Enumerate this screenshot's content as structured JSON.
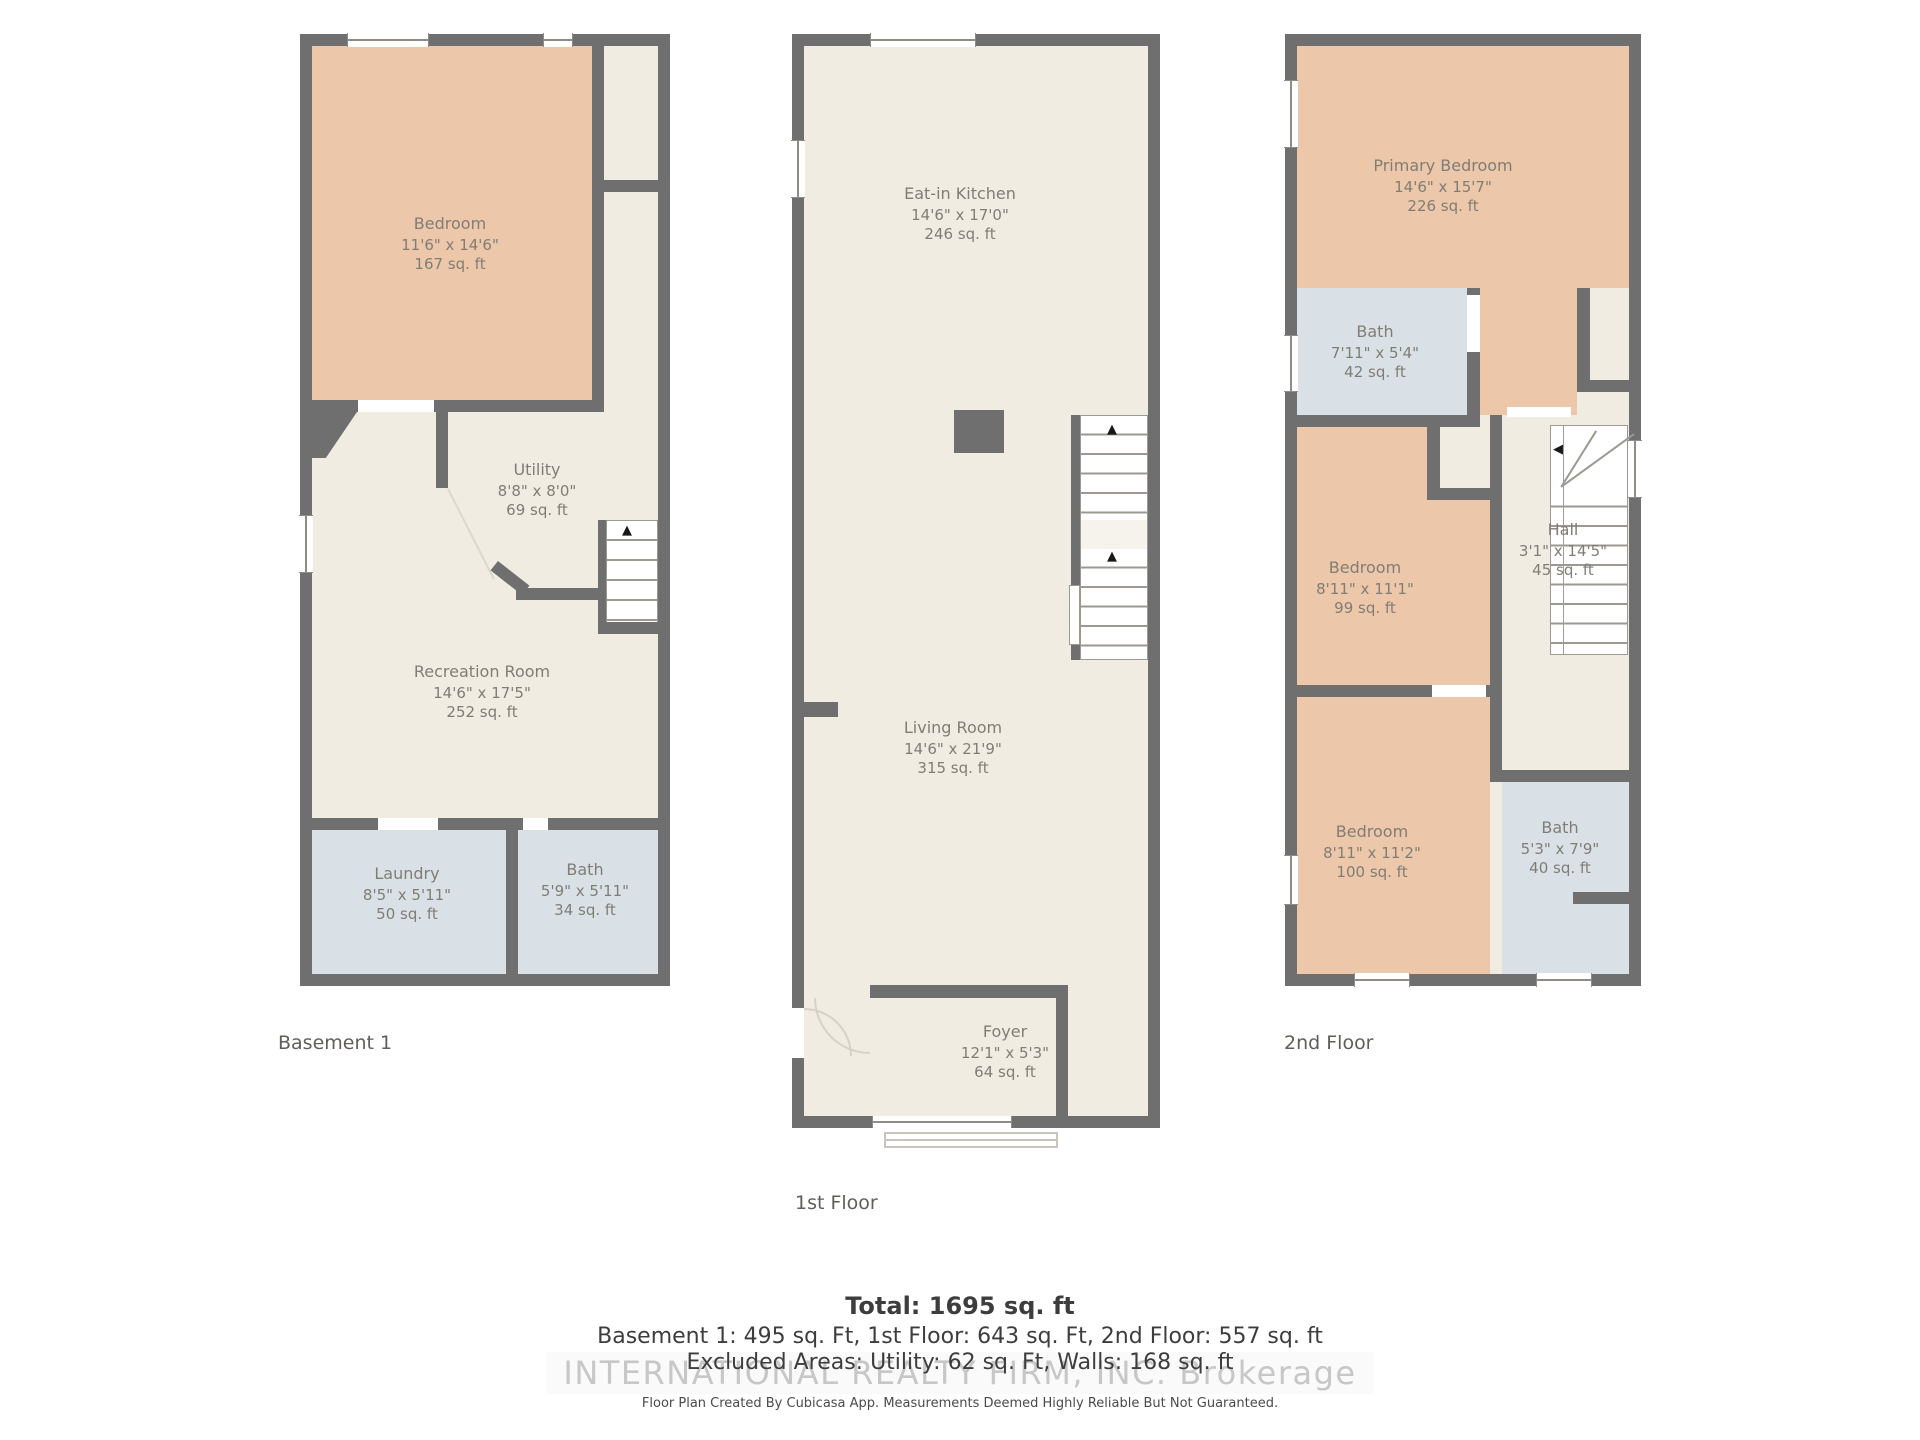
{
  "colors": {
    "wall": "#6f6f6f",
    "floor": "#f0ece2",
    "room_peach": "#ecc7a9",
    "room_blue": "#d9e1e6",
    "room_label": "#807d75",
    "summary_text": "#3d3d3d",
    "watermark": "#c7c7c7"
  },
  "icons": {
    "up_arrow": "▲",
    "left_arrow": "◀"
  },
  "floors": [
    {
      "caption": "Basement 1",
      "rooms": [
        {
          "name": "Bedroom",
          "dims": "11'6\" x 14'6\"",
          "area": "167 sq. ft"
        },
        {
          "name": "Utility",
          "dims": "8'8\" x 8'0\"",
          "area": "69 sq. ft"
        },
        {
          "name": "Recreation Room",
          "dims": "14'6\" x 17'5\"",
          "area": "252 sq. ft"
        },
        {
          "name": "Laundry",
          "dims": "8'5\" x 5'11\"",
          "area": "50 sq. ft"
        },
        {
          "name": "Bath",
          "dims": "5'9\" x 5'11\"",
          "area": "34 sq. ft"
        }
      ]
    },
    {
      "caption": "1st Floor",
      "rooms": [
        {
          "name": "Eat-in Kitchen",
          "dims": "14'6\" x 17'0\"",
          "area": "246 sq. ft"
        },
        {
          "name": "Living Room",
          "dims": "14'6\" x 21'9\"",
          "area": "315 sq. ft"
        },
        {
          "name": "Foyer",
          "dims": "12'1\" x 5'3\"",
          "area": "64 sq. ft"
        }
      ]
    },
    {
      "caption": "2nd Floor",
      "rooms": [
        {
          "name": "Primary Bedroom",
          "dims": "14'6\" x 15'7\"",
          "area": "226 sq. ft"
        },
        {
          "name": "Bath",
          "dims": "7'11\" x 5'4\"",
          "area": "42 sq. ft"
        },
        {
          "name": "Bedroom",
          "dims": "8'11\" x 11'1\"",
          "area": "99 sq. ft"
        },
        {
          "name": "Hall",
          "dims": "3'1\" x 14'5\"",
          "area": "45 sq. ft"
        },
        {
          "name": "Bedroom",
          "dims": "8'11\" x 11'2\"",
          "area": "100 sq. ft"
        },
        {
          "name": "Bath",
          "dims": "5'3\" x 7'9\"",
          "area": "40 sq. ft"
        }
      ]
    }
  ],
  "summary": {
    "total": "Total: 1695 sq. ft",
    "breakdown": "Basement 1: 495 sq. Ft, 1st Floor: 643 sq. Ft, 2nd Floor: 557 sq. ft",
    "excluded": "Excluded Areas: Utility: 62 sq. Ft, Walls: 168 sq. ft",
    "watermark": "INTERNATIONAL REALTY FIRM, INC.  Brokerage",
    "disclaimer": "Floor Plan Created By Cubicasa App. Measurements Deemed Highly Reliable But Not Guaranteed."
  }
}
